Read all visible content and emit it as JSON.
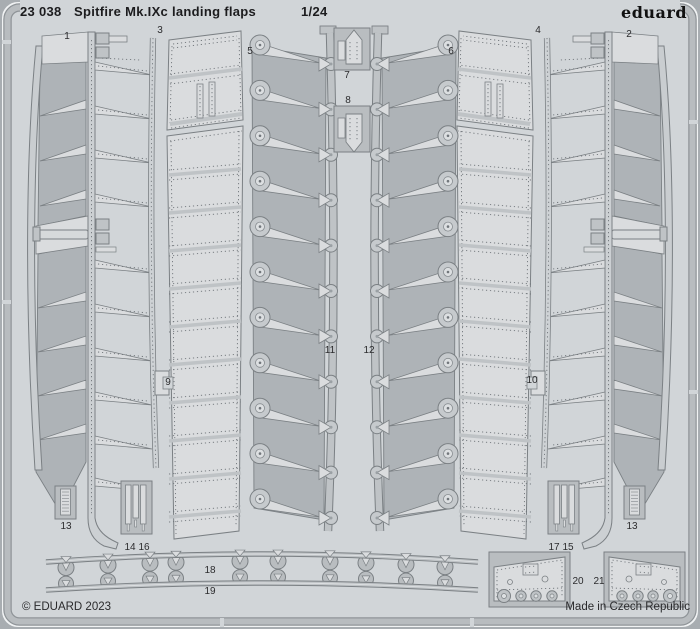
{
  "header": {
    "catalog_number": "23 038",
    "title": "Spitfire Mk.IXc landing flaps",
    "scale": "1/24",
    "brand": "eduard"
  },
  "footer": {
    "copyright": "© EDUARD 2023",
    "made_in": "Made in Czech Republic"
  },
  "colors": {
    "outer": "#a8adb1",
    "sheet_bg": "#d1d5d8",
    "frame_mid": "#b8bcbf",
    "frame_edge": "#8f9498",
    "separator": "#f0f2f3",
    "part_light": "#dadcde",
    "part_mid": "#bfc3c6",
    "part_box": "#b9bdc0",
    "part_dark": "#aeb3b7",
    "blade": "#c9cdd0",
    "outline": "#7b8084",
    "rivet": "#71767b",
    "text": "#1c1c1e",
    "label_text": "#2c2c2e"
  },
  "part_labels": [
    {
      "text": "1",
      "x": 67,
      "y": 37
    },
    {
      "text": "3",
      "x": 160,
      "y": 31
    },
    {
      "text": "5",
      "x": 250,
      "y": 52
    },
    {
      "text": "7",
      "x": 347,
      "y": 76
    },
    {
      "text": "8",
      "x": 348,
      "y": 101
    },
    {
      "text": "6",
      "x": 451,
      "y": 52
    },
    {
      "text": "4",
      "x": 538,
      "y": 31
    },
    {
      "text": "2",
      "x": 629,
      "y": 35
    },
    {
      "text": "9",
      "x": 168,
      "y": 383
    },
    {
      "text": "11",
      "x": 330,
      "y": 351
    },
    {
      "text": "12",
      "x": 369,
      "y": 351
    },
    {
      "text": "10",
      "x": 532,
      "y": 381
    },
    {
      "text": "13",
      "x": 66,
      "y": 527
    },
    {
      "text": "14",
      "x": 130,
      "y": 548
    },
    {
      "text": "16",
      "x": 144,
      "y": 548
    },
    {
      "text": "17",
      "x": 554,
      "y": 548
    },
    {
      "text": "15",
      "x": 568,
      "y": 548
    },
    {
      "text": "13",
      "x": 632,
      "y": 527
    },
    {
      "text": "18",
      "x": 210,
      "y": 571
    },
    {
      "text": "19",
      "x": 210,
      "y": 592
    },
    {
      "text": "20",
      "x": 578,
      "y": 582
    },
    {
      "text": "21",
      "x": 599,
      "y": 582
    }
  ]
}
